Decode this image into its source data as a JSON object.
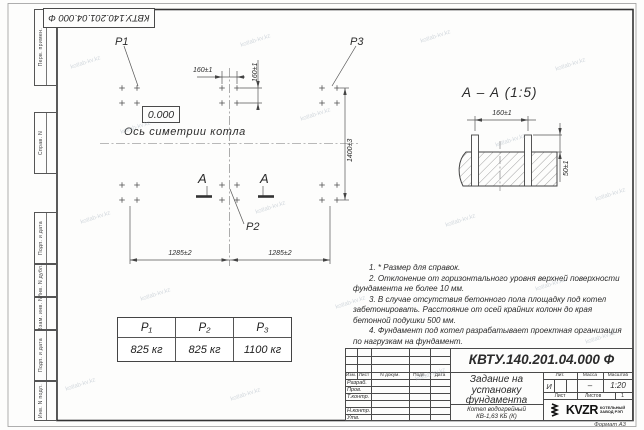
{
  "frame": {
    "top_stamp": "КВТУ.140.201.04.000  Ф",
    "margin_fields": [
      "Перв. примен.",
      "Справ. N",
      "Подп. и дата",
      "Инв. N дубл.",
      "Взам. инв. N",
      "Подп. и дата",
      "Инв. N подл."
    ],
    "format_note": "Формат А3"
  },
  "plan": {
    "elevation": "0.000",
    "axis_label": "Ось симетрии котла",
    "p1": "P1",
    "p2": "P2",
    "p3": "P3",
    "section_mark": "А",
    "dims": {
      "d160h": "160±1",
      "d160v": "160±1",
      "d1400": "1400±3",
      "d1285_left": "1285±2",
      "d1285_right": "1285±2"
    }
  },
  "section": {
    "title": "А – А (1:5)",
    "dim160": "160±1",
    "dim50": "50±1"
  },
  "notes": {
    "items": [
      "1. * Размер для справок.",
      "2. Отклонение от горизонтального уровня верхней поверхности фундамента не более 10 мм.",
      "3. В случае отсутствия бетонного пола площадку под котел забетонировать. Расстояние от осей крайних колонн до края бетонной подушки 500 мм.",
      "4. Фундамент под котел разрабатывает проектная организация по нагрузкам на фундамент."
    ]
  },
  "load_table": {
    "headers": [
      "Р₁",
      "Р₂",
      "Р₃"
    ],
    "values": [
      "825 кг",
      "825 кг",
      "1100 кг"
    ]
  },
  "title_block": {
    "designation": "КВТУ.140.201.04.000  Ф",
    "doc_title": "Задание на установку фундамента",
    "product_line1": "Котел водогрейный",
    "product_line2": "КВ-1,63 КБ (К)",
    "rev_headers": [
      "Изм.",
      "Лист",
      "N докум.",
      "Подп.",
      "Дата"
    ],
    "sign_labels": [
      "Разраб.",
      "Пров.",
      "Т.контр.",
      "Н.контр.",
      "Утв."
    ],
    "lit_label": "Лит.",
    "lit_value": "И",
    "mass_label": "Масса",
    "mass_value": "–",
    "scale_label": "Масштаб",
    "scale_value": "1:20",
    "sheet_label": "Лист",
    "sheets_label": "Листов",
    "sheets_value": "1",
    "company": "KVZR",
    "company_sub1": "КОТЕЛЬНЫЙ",
    "company_sub2": "ЗАВОД РЭП"
  },
  "watermark": {
    "text": "kotlab-kv.kz"
  },
  "colors": {
    "line": "#4a4a4a",
    "paper": "#fdfdfc"
  }
}
